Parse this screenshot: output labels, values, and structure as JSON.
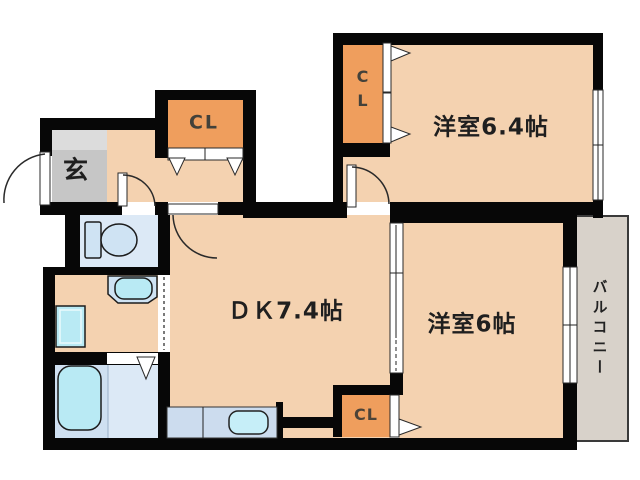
{
  "plan": {
    "title": "apartment-floor-plan",
    "labels": {
      "genkan": "玄",
      "hall_closet": "CL",
      "room64_closet": "CL",
      "room64": "洋室6.4帖",
      "dk": "ＤＫ7.4帖",
      "room6": "洋室6帖",
      "dk_closet": "CL",
      "balcony": "バルコニー"
    },
    "colors": {
      "wall": "#070707",
      "room_floor": "#f4d2b0",
      "closet_fill": "#ef9e5d",
      "genkan_floor": "#c6c6c6",
      "genkan_step": "#dcdcdc",
      "wet_room_floor": "#dce9f6",
      "bathroom_floor": "#cfe0f1",
      "water_fixture": "#b9eaf4",
      "kitchen_counter": "#ccdcee",
      "balcony_floor": "#d8d2ca",
      "background": "#ffffff"
    }
  }
}
